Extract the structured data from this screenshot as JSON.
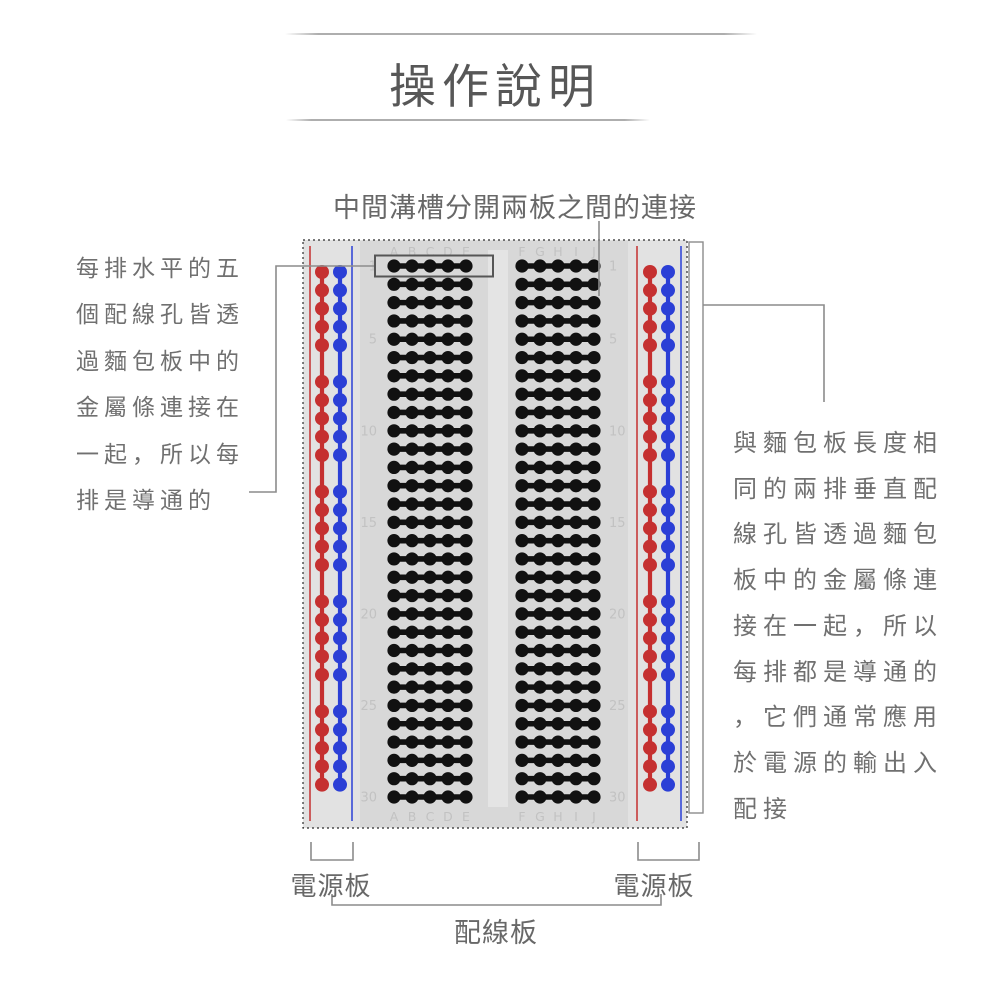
{
  "title": "操作說明",
  "annotations": {
    "top": "中間溝槽分開兩板之間的連接",
    "left_lines": [
      "每排水平的五",
      "個配線孔皆透",
      "過麵包板中的",
      "金屬條連接在",
      "一起，所以每",
      "排是導通的"
    ],
    "right_lines": [
      "與麵包板長度相",
      "同的兩排垂直配",
      "線孔皆透過麵包",
      "板中的金屬條連",
      "接在一起，所以",
      "每排都是導通的",
      "，它們通常應用",
      "於電源的輸出入",
      "配接"
    ]
  },
  "labels": {
    "power_left": "電源板",
    "power_right": "電源板",
    "wiring": "配線板"
  },
  "breadboard": {
    "row_count": 30,
    "row_numbers": [
      1,
      5,
      10,
      15,
      20,
      25,
      30
    ],
    "left_columns": [
      "A",
      "B",
      "C",
      "D",
      "E"
    ],
    "right_columns": [
      "F",
      "G",
      "H",
      "I",
      "J"
    ],
    "power_rail": {
      "groups": 5,
      "holes_per_group": 5,
      "rail_colors": [
        "red",
        "blue"
      ]
    },
    "colors": {
      "board": "#e2e2e2",
      "grid_section": "#d8d8d8",
      "groove": "#e4e4e4",
      "hole": "#111111",
      "red": "#c53030",
      "blue": "#2b3fd6",
      "label_text": "#c2c2c2",
      "border": "#2b2b2b",
      "callout": "#8c8c8c",
      "highlight_box": "#565656"
    }
  }
}
